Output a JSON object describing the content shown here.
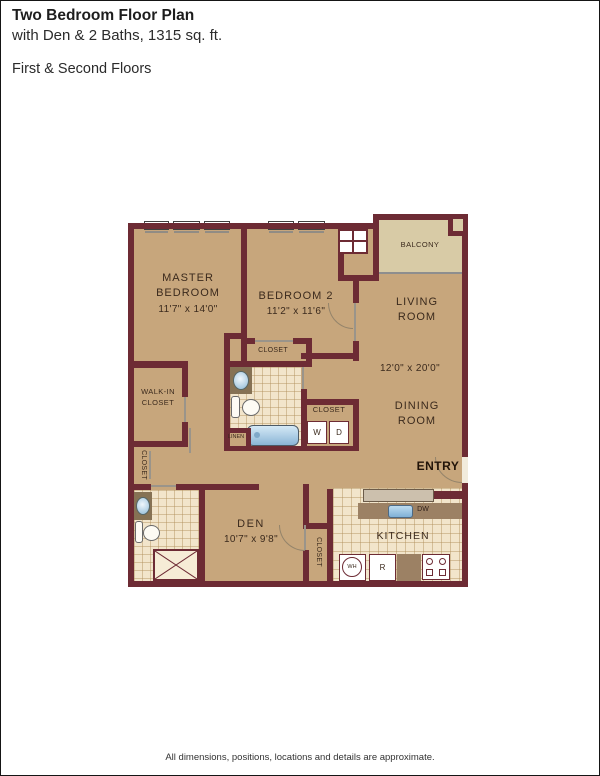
{
  "header": {
    "title": "Two Bedroom Floor Plan",
    "subtitle": "with Den & 2 Baths, 1315 sq. ft.",
    "floors": "First & Second Floors"
  },
  "footer": {
    "disclaimer": "All dimensions, positions, locations and details are approximate."
  },
  "plan": {
    "rooms": {
      "master": {
        "l1": "MASTER",
        "l2": "BEDROOM",
        "dims": "11'7\" x 14'0\""
      },
      "bedroom2": {
        "l1": "BEDROOM 2",
        "dims": "11'2\" x 11'6\""
      },
      "living": {
        "l1": "LIVING",
        "l2": "ROOM"
      },
      "living_dining_dims": "12'0\" x 20'0\"",
      "dining": {
        "l1": "DINING",
        "l2": "ROOM"
      },
      "balcony": "BALCONY",
      "entry": "ENTRY",
      "den": {
        "l1": "DEN",
        "dims": "10'7\" x 9'8\""
      },
      "kitchen": "KITCHEN",
      "walk_in": {
        "l1": "WALK-IN",
        "l2": "CLOSET"
      }
    },
    "closets": {
      "bedroom2": "CLOSET",
      "hall": "CLOSET",
      "entry_left": "CLOSET",
      "kitchen": "CLOSET",
      "linen": "LINEN"
    },
    "appliances": {
      "washer": "W",
      "dryer": "D",
      "dishwasher": "DW",
      "water_heater": "WH",
      "refrigerator": "R"
    },
    "colors": {
      "wall": "#6d2b34",
      "floor": "#c7a67c",
      "balcony_floor": "#d8cba6",
      "tile": "#f2e5cb",
      "counter": "#9c8164"
    }
  }
}
